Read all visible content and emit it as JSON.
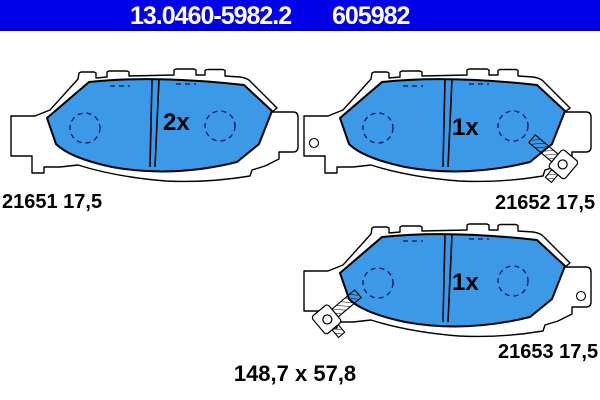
{
  "header": {
    "catalog_number": "13.0460-5982.2",
    "article_number": "605982"
  },
  "colors": {
    "header_bg": "#0202e8",
    "header_edge": "#0000a0",
    "header_text": "#ffffff",
    "pad_fill": "#3b99e8",
    "plate_fill": "#ffffff",
    "outline": "#000000",
    "hidden_line": "#121258"
  },
  "pads": [
    {
      "quantity_label": "2x",
      "part_label": "21651 17,5"
    },
    {
      "quantity_label": "1x",
      "part_label": "21652 17,5"
    },
    {
      "quantity_label": "1x",
      "part_label": "21653 17,5"
    }
  ],
  "dimensions": {
    "label": "148,7 x 57,8"
  }
}
